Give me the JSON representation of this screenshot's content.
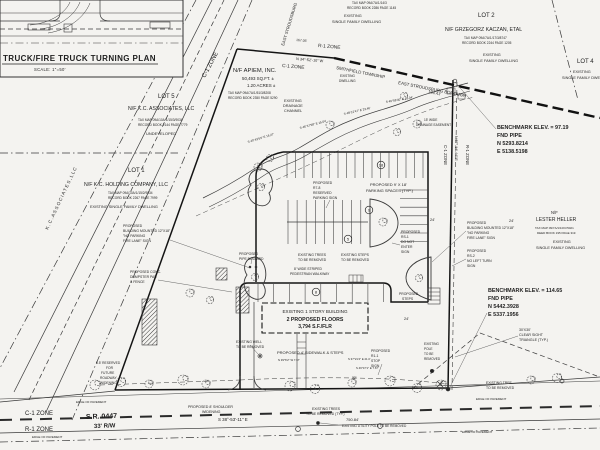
{
  "title_block": {
    "inset_title": "TRUCK/FIRE TRUCK TURNING PLAN",
    "inset_scale": "SCALE: 1\"=50'"
  },
  "colors": {
    "paper": "#f4f3f0",
    "ink": "#3a3a3a",
    "heavy_line": "#141414",
    "text": "#1f1f1f"
  },
  "labels": [
    {
      "t": "C-1 ZONE",
      "x": 205,
      "y": 78,
      "s": 6,
      "r": -62,
      "n": "zone-label-c1-road"
    },
    {
      "t": "EAST STROUDSBURG",
      "x": 284,
      "y": 46,
      "s": 4.2,
      "r": -73,
      "n": "street-name"
    },
    {
      "t": "TAX MAP 09A/7A/1/14/3",
      "x": 352,
      "y": 4,
      "s": 3.2
    },
    {
      "t": "RECORD BOOK 2286 PAGE 1145",
      "x": 347,
      "y": 9,
      "s": 3.2
    },
    {
      "t": "EXISTING",
      "x": 344,
      "y": 17,
      "s": 3.8
    },
    {
      "t": "SINGLE FAMILY DWELLING",
      "x": 332,
      "y": 23,
      "s": 3.8
    },
    {
      "t": "LOT 2",
      "x": 478,
      "y": 17,
      "s": 6,
      "n": "lot2-label"
    },
    {
      "t": "N/F GRZEGORZ KACZAN, ETAL",
      "x": 445,
      "y": 31,
      "s": 5.2,
      "n": "lot2-owner"
    },
    {
      "t": "TAX MAP 09A/7A/1/17/3/8747",
      "x": 464,
      "y": 39,
      "s": 3.2
    },
    {
      "t": "RECORD BOOK 2244 PAGE 1205",
      "x": 462,
      "y": 44,
      "s": 3.2
    },
    {
      "t": "EXISTING",
      "x": 483,
      "y": 56,
      "s": 3.8
    },
    {
      "t": "SINGLE FAMILY DWELLING",
      "x": 469,
      "y": 62,
      "s": 3.8
    },
    {
      "t": "LOT 4",
      "x": 577,
      "y": 63,
      "s": 6,
      "n": "lot4-label"
    },
    {
      "t": "EXISTING",
      "x": 573,
      "y": 73,
      "s": 3.8
    },
    {
      "t": "SINGLE FAMILY DWELLING",
      "x": 562,
      "y": 79,
      "s": 3.8
    },
    {
      "t": "SMITHFIELD TOWNSHIP",
      "x": 336,
      "y": 69,
      "s": 4.3,
      "r": 11,
      "n": "township-label"
    },
    {
      "t": "EAST STROUDSBURG BOROUGH",
      "x": 398,
      "y": 84,
      "s": 4.3,
      "r": 11,
      "n": "borough-label"
    },
    {
      "t": "184.41'",
      "x": 428,
      "y": 93,
      "s": 4,
      "r": 11
    },
    {
      "t": "R-1 ZONE",
      "x": 318,
      "y": 47,
      "s": 4.8,
      "r": 5
    },
    {
      "t": "N 34°-52'-10\" W",
      "x": 296,
      "y": 60,
      "s": 3.8,
      "r": 5
    },
    {
      "t": "C-1 ZONE",
      "x": 282,
      "y": 67,
      "s": 4.8,
      "r": 5
    },
    {
      "t": "167.05'",
      "x": 296,
      "y": 41,
      "s": 3.4,
      "r": 5
    },
    {
      "t": "N/F APIEM, INC.",
      "x": 233,
      "y": 72,
      "s": 5.8,
      "n": "subject-owner"
    },
    {
      "t": "50,493 SQ.FT. ±",
      "x": 242,
      "y": 80,
      "s": 4.4
    },
    {
      "t": "1.20 ACRES ±",
      "x": 247,
      "y": 87,
      "s": 4.4
    },
    {
      "t": "TAX MAP 09A/7A/1/51/3/8208",
      "x": 228,
      "y": 94,
      "s": 3.2
    },
    {
      "t": "RECORD BOOK 2350 PAGE 5290",
      "x": 228,
      "y": 99,
      "s": 3.2
    },
    {
      "t": "EXISTING",
      "x": 284,
      "y": 102,
      "s": 3.8
    },
    {
      "t": "DRAINAGE",
      "x": 283,
      "y": 107,
      "s": 3.8
    },
    {
      "t": "CHANNEL",
      "x": 284,
      "y": 112,
      "s": 3.8
    },
    {
      "t": "EXISTING",
      "x": 340,
      "y": 77,
      "s": 3.2
    },
    {
      "t": "DWELLING",
      "x": 339,
      "y": 82,
      "s": 3.2
    },
    {
      "t": "15' WIDE",
      "x": 424,
      "y": 121,
      "s": 3.2
    },
    {
      "t": "DRAINAGE EASEMENT",
      "x": 416,
      "y": 126,
      "s": 3.2
    },
    {
      "t": "S 40°43'53\" E  18.27'",
      "x": 248,
      "y": 143,
      "s": 3,
      "r": -17
    },
    {
      "t": "S 46°47'58\" E  15.04'",
      "x": 300,
      "y": 129,
      "s": 3,
      "r": -15
    },
    {
      "t": "S 48°12'47\" E  23.46'",
      "x": 344,
      "y": 115,
      "s": 3,
      "r": -13
    },
    {
      "t": "S 49°58'40\" E  15.04'",
      "x": 386,
      "y": 103,
      "s": 3,
      "r": -10
    },
    {
      "t": "BENCHMARK ELEV. = 97.19",
      "x": 497,
      "y": 129,
      "s": 5.4,
      "f": "b",
      "n": "benchmark-1"
    },
    {
      "t": "FND PIPE",
      "x": 497,
      "y": 137,
      "s": 5.4,
      "f": "b"
    },
    {
      "t": "N 5293.8214",
      "x": 497,
      "y": 145,
      "s": 5.4,
      "f": "b"
    },
    {
      "t": "E 5138.5198",
      "x": 497,
      "y": 153,
      "s": 5.4,
      "f": "b"
    },
    {
      "t": "BENCHMARK ELEV. = 114.65",
      "x": 488,
      "y": 292,
      "s": 5.4,
      "f": "b",
      "n": "benchmark-2"
    },
    {
      "t": "FND PIPE",
      "x": 488,
      "y": 300,
      "s": 5.4,
      "f": "b"
    },
    {
      "t": "N 5442.3928",
      "x": 488,
      "y": 308,
      "s": 5.4,
      "f": "b"
    },
    {
      "t": "E 5337.1956",
      "x": 488,
      "y": 316,
      "s": 5.4,
      "f": "b"
    },
    {
      "t": "C-1 ZONE",
      "x": 444,
      "y": 145,
      "s": 4.3,
      "r": 90
    },
    {
      "t": "N 57°-14'-44\" E",
      "x": 455,
      "y": 136,
      "s": 3.6,
      "r": 90
    },
    {
      "t": "R-1 ZONE",
      "x": 466,
      "y": 145,
      "s": 4.3,
      "r": 90
    },
    {
      "t": "LOT 5",
      "x": 158,
      "y": 98,
      "s": 6,
      "n": "lot5-label"
    },
    {
      "t": "N/F K.C. ASSOCIATES, LLC",
      "x": 128,
      "y": 110,
      "s": 5.2,
      "n": "lot5-owner"
    },
    {
      "t": "TAX MAP 09A/10A/1/15/3/9034",
      "x": 138,
      "y": 121,
      "s": 3.2
    },
    {
      "t": "RECORD BOOK 2144 PAGE 7779",
      "x": 138,
      "y": 126,
      "s": 3.2
    },
    {
      "t": "UNDEVELOPED",
      "x": 146,
      "y": 135,
      "s": 4
    },
    {
      "t": "LOT 1",
      "x": 128,
      "y": 172,
      "s": 6,
      "n": "lot1-label"
    },
    {
      "t": "N/F K.C. HOLDING COMPANY, LLC",
      "x": 84,
      "y": 186,
      "s": 5.2,
      "n": "lot1-owner"
    },
    {
      "t": "TAX MAP 09A/10A/1/15/2/9034",
      "x": 108,
      "y": 194,
      "s": 3.2
    },
    {
      "t": "RECORD BOOK 2267 PAGE 7999",
      "x": 108,
      "y": 199,
      "s": 3.2
    },
    {
      "t": "EXISTING SINGLE FAMILY DWELLING",
      "x": 90,
      "y": 208,
      "s": 3.8
    },
    {
      "t": "K . C .   A S S O C I A T E S ,   L L C",
      "x": 48,
      "y": 230,
      "s": 4.6,
      "r": -65,
      "n": "kc-associates-boundary-text"
    },
    {
      "t": "N/F",
      "x": 551,
      "y": 214,
      "s": 4.2
    },
    {
      "t": "LESTER HELLER",
      "x": 536,
      "y": 221,
      "s": 5,
      "n": "heller-owner"
    },
    {
      "t": "TAX MAP 09/7A/1/10/C/5021",
      "x": 535,
      "y": 229,
      "s": 3
    },
    {
      "t": "DEED BOOK 195 PAGE 319",
      "x": 537,
      "y": 234,
      "s": 3
    },
    {
      "t": "EXISTING",
      "x": 553,
      "y": 243,
      "s": 3.8
    },
    {
      "t": "SINGLE FAMILY DWELLING",
      "x": 536,
      "y": 249,
      "s": 3.8
    },
    {
      "t": "PROPOSED",
      "x": 123,
      "y": 227,
      "s": 3.4,
      "n": "fire-lane-sign-note-left"
    },
    {
      "t": "BUILDING MOUNTED 12\"X18\"",
      "x": 123,
      "y": 232,
      "s": 3.4
    },
    {
      "t": "\"NO PARKING",
      "x": 123,
      "y": 237,
      "s": 3.4
    },
    {
      "t": "FIRE LANE\" SIGN",
      "x": 123,
      "y": 242,
      "s": 3.4
    },
    {
      "t": "PROPOSED",
      "x": 467,
      "y": 224,
      "s": 3.4,
      "n": "fire-lane-sign-note-right"
    },
    {
      "t": "BUILDING MOUNTED 12\"X18\"",
      "x": 467,
      "y": 229,
      "s": 3.4
    },
    {
      "t": "\"NO PARKING",
      "x": 467,
      "y": 234,
      "s": 3.4
    },
    {
      "t": "FIRE LANE\" SIGN",
      "x": 467,
      "y": 239,
      "s": 3.4
    },
    {
      "t": "PROPOSED",
      "x": 467,
      "y": 252,
      "s": 3.4,
      "n": "no-left-turn-sign-note"
    },
    {
      "t": "RS-2",
      "x": 467,
      "y": 257,
      "s": 3.4
    },
    {
      "t": "NO LEFT TURN",
      "x": 467,
      "y": 262,
      "s": 3.4
    },
    {
      "t": "SIGN",
      "x": 467,
      "y": 267,
      "s": 3.4
    },
    {
      "t": "PROPOSED",
      "x": 401,
      "y": 233,
      "s": 3.4,
      "n": "do-not-enter-sign-note"
    },
    {
      "t": "RS-1",
      "x": 401,
      "y": 238,
      "s": 3.4
    },
    {
      "t": "DO NOT",
      "x": 401,
      "y": 243,
      "s": 3.4
    },
    {
      "t": "ENTER",
      "x": 401,
      "y": 248,
      "s": 3.4
    },
    {
      "t": "SIGN",
      "x": 401,
      "y": 253,
      "s": 3.4
    },
    {
      "t": "PROPOSED",
      "x": 313,
      "y": 184,
      "s": 3.4,
      "n": "reserved-parking-sign-note"
    },
    {
      "t": "R7-8",
      "x": 313,
      "y": 189,
      "s": 3.4
    },
    {
      "t": "RESERVED",
      "x": 313,
      "y": 194,
      "s": 3.4
    },
    {
      "t": "PARKING SIGN",
      "x": 313,
      "y": 199,
      "s": 3.4
    },
    {
      "t": "PROPOSED CONC.",
      "x": 130,
      "y": 273,
      "s": 3.4,
      "n": "dumpster-note"
    },
    {
      "t": "DUMPSTER PAD",
      "x": 130,
      "y": 278,
      "s": 3.4
    },
    {
      "t": "& FENCE",
      "x": 130,
      "y": 283,
      "s": 3.4
    },
    {
      "t": "PROPOSED",
      "x": 239,
      "y": 255,
      "s": 3.4,
      "n": "pipe-bollard-note"
    },
    {
      "t": "PIPE BOLLARD",
      "x": 239,
      "y": 260,
      "s": 3.4
    },
    {
      "t": "PROPOSED",
      "x": 371,
      "y": 352,
      "s": 3.4,
      "n": "stop-sign-note"
    },
    {
      "t": "R1-1",
      "x": 371,
      "y": 357,
      "s": 3.4
    },
    {
      "t": "STOP",
      "x": 371,
      "y": 362,
      "s": 3.4
    },
    {
      "t": "SIGN",
      "x": 371,
      "y": 367,
      "s": 3.4
    },
    {
      "t": "PROPOSED 4' SIDEWALK & STEPS",
      "x": 277,
      "y": 354,
      "s": 4,
      "n": "sidewalk-note"
    },
    {
      "t": "EXISTING TREES",
      "x": 298,
      "y": 256,
      "s": 3.4
    },
    {
      "t": "TO BE REMOVED",
      "x": 298,
      "y": 261,
      "s": 3.4
    },
    {
      "t": "8' WIDE STRIPED",
      "x": 294,
      "y": 270,
      "s": 3.4,
      "n": "walkway-note"
    },
    {
      "t": "PEDESTRIAN WALKWAY",
      "x": 290,
      "y": 275,
      "s": 3.4
    },
    {
      "t": "EXISTING STEPS",
      "x": 341,
      "y": 256,
      "s": 3.4
    },
    {
      "t": "TO BE REMOVED",
      "x": 341,
      "y": 261,
      "s": 3.4
    },
    {
      "t": "PROPOSED",
      "x": 399,
      "y": 295,
      "s": 3.4,
      "n": "proposed-steps-note"
    },
    {
      "t": "STEPS",
      "x": 402,
      "y": 300,
      "s": 3.4
    },
    {
      "t": "EXISTING WELL",
      "x": 236,
      "y": 343,
      "s": 3.4,
      "n": "well-note"
    },
    {
      "t": "TO BE REMOVED",
      "x": 236,
      "y": 348,
      "s": 3.4
    },
    {
      "t": "EXISTING TREES",
      "x": 312,
      "y": 410,
      "s": 3.4
    },
    {
      "t": "TO BE REMOVED (TYP.)",
      "x": 306,
      "y": 415,
      "s": 3.4
    },
    {
      "t": "750.84'",
      "x": 346,
      "y": 421,
      "s": 4,
      "n": "frontage-distance"
    },
    {
      "t": "EXISTING UTILITY POLE TO BE REMOVED",
      "x": 342,
      "y": 427,
      "s": 3.2
    },
    {
      "t": "S 38°-53'-11\" E",
      "x": 218,
      "y": 421,
      "s": 4.4,
      "n": "frontage-bearing"
    },
    {
      "t": "S.R. 0447",
      "x": 86,
      "y": 419,
      "s": 7,
      "f": "b",
      "r": -2,
      "n": "road-name"
    },
    {
      "t": "33' R/W",
      "x": 94,
      "y": 428,
      "s": 6,
      "f": "b",
      "r": -2,
      "n": "road-row"
    },
    {
      "t": "C-1 ZONE",
      "x": 25,
      "y": 415,
      "s": 6,
      "n": "zone-label-c1-bottom"
    },
    {
      "t": "R-1 ZONE",
      "x": 25,
      "y": 431,
      "s": 6,
      "n": "zone-label-r1-bottom"
    },
    {
      "t": "EDGE OF PAVEMENT",
      "x": 76,
      "y": 403,
      "s": 3
    },
    {
      "t": "EDGE OF PAVEMENT",
      "x": 32,
      "y": 438,
      "s": 3
    },
    {
      "t": "EDGE OF PAVEMENT",
      "x": 462,
      "y": 433,
      "s": 3
    },
    {
      "t": "EDGE OF PAVEMENT",
      "x": 476,
      "y": 400,
      "s": 3
    },
    {
      "t": "8.5' RESERVED",
      "x": 96,
      "y": 364,
      "s": 3.3,
      "n": "roadway-widening-note"
    },
    {
      "t": "FOR",
      "x": 106,
      "y": 369,
      "s": 3.3
    },
    {
      "t": "FUTURE",
      "x": 101,
      "y": 374,
      "s": 3.3
    },
    {
      "t": "ROADWAY",
      "x": 100,
      "y": 379,
      "s": 3.3
    },
    {
      "t": "WIDENING",
      "x": 100,
      "y": 384,
      "s": 3.3
    },
    {
      "t": "PROPOSED 8' SHOULDER",
      "x": 188,
      "y": 408,
      "s": 3.6,
      "n": "shoulder-note"
    },
    {
      "t": "WIDENING",
      "x": 202,
      "y": 413,
      "s": 3.6
    },
    {
      "t": "30'X30'",
      "x": 519,
      "y": 331,
      "s": 3.6,
      "n": "sight-triangle-note"
    },
    {
      "t": "CLEAR SIGHT",
      "x": 519,
      "y": 336,
      "s": 3.6
    },
    {
      "t": "TRIANGLE (TYP.)",
      "x": 519,
      "y": 341,
      "s": 3.6
    },
    {
      "t": "EXISTING TREE",
      "x": 486,
      "y": 384,
      "s": 3.4
    },
    {
      "t": "TO BE REMOVED",
      "x": 486,
      "y": 389,
      "s": 3.4
    },
    {
      "t": "EXISTING",
      "x": 424,
      "y": 345,
      "s": 3.2,
      "n": "pole-removed-note"
    },
    {
      "t": "POLE",
      "x": 424,
      "y": 350,
      "s": 3.2
    },
    {
      "t": "TO BE",
      "x": 424,
      "y": 355,
      "s": 3.2
    },
    {
      "t": "REMOVED",
      "x": 424,
      "y": 360,
      "s": 3.2
    },
    {
      "t": "PROPOSED 9' X 18'",
      "x": 370,
      "y": 186,
      "s": 4,
      "n": "parking-spaces-note"
    },
    {
      "t": "PARKING SPACES (TYP.)",
      "x": 366,
      "y": 192,
      "s": 4
    },
    {
      "t": "24'",
      "x": 430,
      "y": 221,
      "s": 3.8
    },
    {
      "t": "24'",
      "x": 509,
      "y": 222,
      "s": 3.8
    },
    {
      "t": "24'",
      "x": 404,
      "y": 320,
      "s": 3.8
    },
    {
      "t": "32'",
      "x": 352,
      "y": 379,
      "s": 3.4
    },
    {
      "t": "N 39°6'2\" W  7.67'",
      "x": 278,
      "y": 361,
      "s": 2.8
    },
    {
      "t": "S 37°21'4\" E  21.0'",
      "x": 348,
      "y": 360,
      "s": 2.8
    },
    {
      "t": "S 46°47'1\" E  7.67'",
      "x": 356,
      "y": 369,
      "s": 2.8
    },
    {
      "t": "EXISTING 1 STORY BUILDING",
      "x": 315,
      "y": 313,
      "s": 4.6,
      "a": "m",
      "n": "building-label"
    },
    {
      "t": "2 PROPOSED FLOORS",
      "x": 315,
      "y": 321,
      "s": 5.2,
      "f": "b",
      "a": "m",
      "n": "building-floors"
    },
    {
      "t": "3,794 S.F./FLR",
      "x": 315,
      "y": 328,
      "s": 5,
      "f": "b",
      "a": "m",
      "n": "building-area"
    }
  ],
  "parking_counts": [
    {
      "t": "18",
      "x": 381,
      "y": 165
    },
    {
      "t": "9",
      "x": 369,
      "y": 210
    },
    {
      "t": "5",
      "x": 348,
      "y": 239
    },
    {
      "t": "8",
      "x": 316,
      "y": 292
    }
  ],
  "symbols": {
    "trees": [
      [
        95,
        385,
        5
      ],
      [
        121,
        382,
        4.5
      ],
      [
        149,
        384,
        4
      ],
      [
        183,
        380,
        5
      ],
      [
        206,
        384,
        4
      ],
      [
        290,
        386,
        5
      ],
      [
        315,
        389,
        4.5
      ],
      [
        352,
        383,
        4
      ],
      [
        390,
        381,
        5
      ],
      [
        417,
        388,
        4.5
      ],
      [
        441,
        385,
        5
      ],
      [
        531,
        380,
        4
      ],
      [
        557,
        378,
        4.5
      ],
      [
        258,
        167,
        4
      ],
      [
        270,
        158,
        3.5
      ],
      [
        330,
        125,
        4
      ],
      [
        404,
        96,
        3.5
      ],
      [
        417,
        124,
        4
      ],
      [
        397,
        132,
        3.5
      ],
      [
        261,
        187,
        3.5
      ],
      [
        255,
        277,
        3.5
      ],
      [
        383,
        222,
        4
      ],
      [
        419,
        278,
        3.5
      ],
      [
        190,
        293,
        4
      ],
      [
        210,
        300,
        3.5
      ]
    ]
  }
}
